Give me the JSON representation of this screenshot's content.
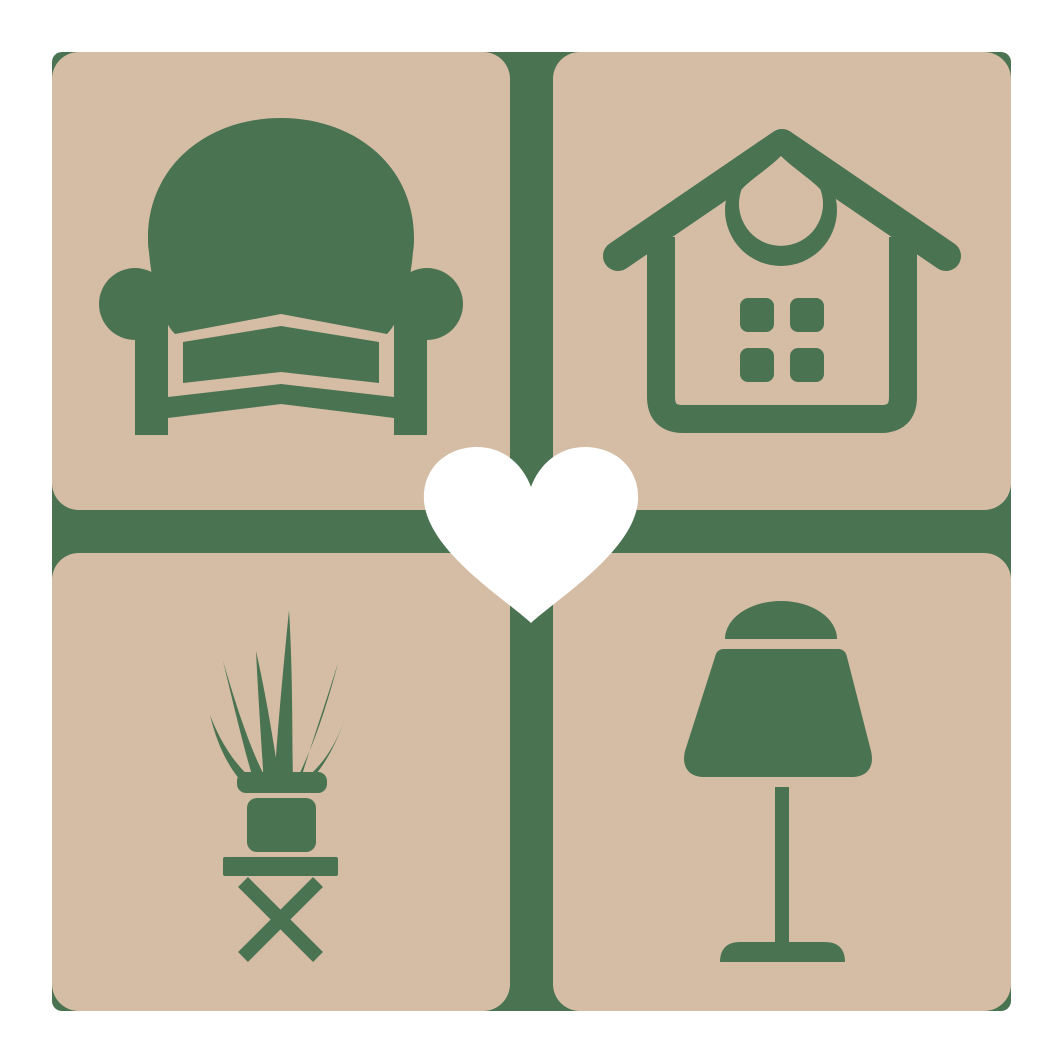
{
  "logo": {
    "colors": {
      "background": "#ffffff",
      "tile": "#d5bda5",
      "accent_green": "#4a7352",
      "heart": "#ffffff"
    },
    "layout": {
      "grid": "2x2",
      "tile_count": 4,
      "center_symbol": "heart"
    },
    "tiles": [
      {
        "position": "top-left",
        "icon": "armchair-icon",
        "label": "armchair"
      },
      {
        "position": "top-right",
        "icon": "house-icon",
        "label": "house"
      },
      {
        "position": "bottom-left",
        "icon": "potted-plant-icon",
        "label": "potted plant on stool"
      },
      {
        "position": "bottom-right",
        "icon": "table-lamp-icon",
        "label": "table lamp"
      }
    ],
    "center": {
      "icon": "heart-icon",
      "label": "heart"
    }
  }
}
